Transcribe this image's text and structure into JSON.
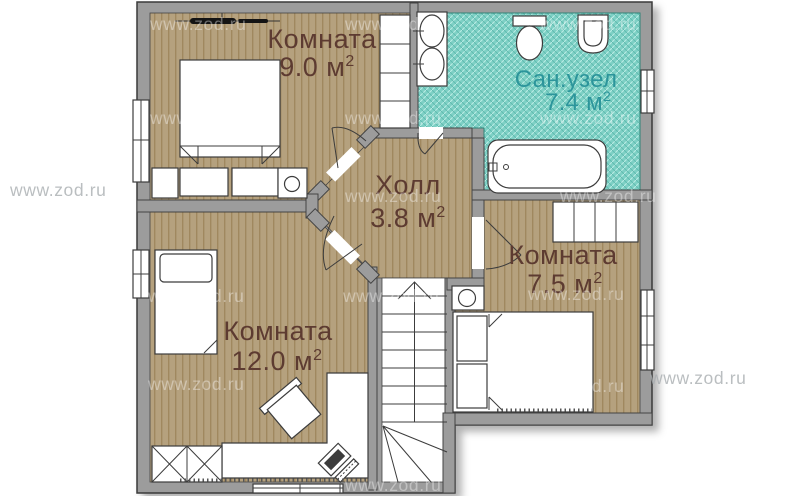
{
  "plan": {
    "title": "Floor plan, second storey",
    "watermark": "www.zod.ru",
    "rooms": {
      "room9": {
        "name": "Комната",
        "area": "9.0 м",
        "sup": "2"
      },
      "bath": {
        "name": "Сан.узел",
        "area": "7.4 м",
        "sup": "2"
      },
      "hall": {
        "name": "Холл",
        "area": "3.8 м",
        "sup": "2"
      },
      "room75": {
        "name": "Комната",
        "area": "7.5 м",
        "sup": "2"
      },
      "room12": {
        "name": "Комната",
        "area": "12.0 м",
        "sup": "2"
      }
    },
    "colors": {
      "floor": "#b5a17e",
      "floor_stripe": "#a0885f",
      "bath_fill": "#7ed0c5",
      "bath_label": "#2c959b",
      "room_label": "#5d3b31",
      "wall": "#9c9c9c",
      "background": "#ffffff"
    }
  }
}
